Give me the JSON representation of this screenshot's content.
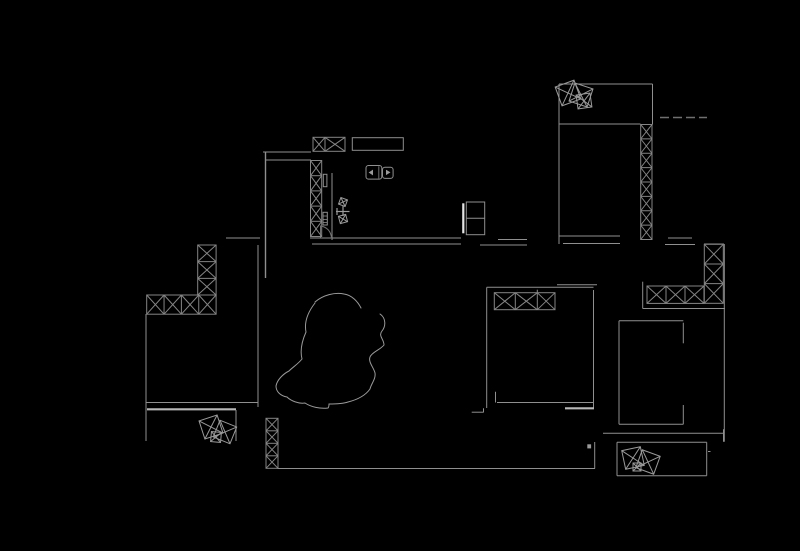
{
  "canvas": {
    "width": 800,
    "height": 551,
    "background": "#000000"
  },
  "colors": {
    "line": "#8f8f8f",
    "hatch": "#858585",
    "dim": "#6f6f6f",
    "bright": "#b8b8b8",
    "symbol": "#9a9a9a",
    "fill_marker": "#9a9a9a",
    "fridge_bar": "#e4e4e4"
  },
  "drawing": {
    "lines": [
      {
        "x1": 263,
        "y1": 152,
        "x2": 311,
        "y2": 152
      },
      {
        "x1": 266,
        "y1": 160,
        "x2": 311,
        "y2": 160
      },
      {
        "x1": 265.5,
        "y1": 152,
        "x2": 265.5,
        "y2": 278,
        "w": 1.4
      },
      {
        "x1": 332,
        "y1": 173,
        "x2": 332,
        "y2": 240
      },
      {
        "x1": 310,
        "y1": 238,
        "x2": 461,
        "y2": 238
      },
      {
        "x1": 312,
        "y1": 244,
        "x2": 461,
        "y2": 244
      },
      {
        "x1": 226,
        "y1": 238,
        "x2": 260,
        "y2": 238
      },
      {
        "x1": 258,
        "y1": 245,
        "x2": 258,
        "y2": 407
      },
      {
        "x1": 320.5,
        "y1": 225.5,
        "x2": 320.5,
        "y2": 237.5,
        "c": "dim"
      },
      {
        "x1": 498,
        "y1": 239.5,
        "x2": 527,
        "y2": 239.5
      },
      {
        "x1": 480,
        "y1": 245,
        "x2": 527,
        "y2": 245
      },
      {
        "x1": 559,
        "y1": 236,
        "x2": 620,
        "y2": 236
      },
      {
        "x1": 563,
        "y1": 243.5,
        "x2": 620,
        "y2": 243.5
      },
      {
        "x1": 559,
        "y1": 234,
        "x2": 559,
        "y2": 244
      },
      {
        "x1": 668,
        "y1": 238,
        "x2": 692,
        "y2": 238
      },
      {
        "x1": 665,
        "y1": 244.5,
        "x2": 695,
        "y2": 244.5
      },
      {
        "x1": 704,
        "y1": 244,
        "x2": 724,
        "y2": 244
      },
      {
        "x1": 559,
        "y1": 84,
        "x2": 652.5,
        "y2": 84
      },
      {
        "x1": 559,
        "y1": 84,
        "x2": 559,
        "y2": 238.5
      },
      {
        "x1": 652.5,
        "y1": 84,
        "x2": 652.5,
        "y2": 124.5
      },
      {
        "x1": 559,
        "y1": 124,
        "x2": 640.5,
        "y2": 124
      },
      {
        "x1": 660,
        "y1": 117.5,
        "x2": 707,
        "y2": 117.5,
        "c": "dim",
        "w": 1.5,
        "dash": "9,4"
      },
      {
        "x1": 563,
        "y1": 243.5,
        "x2": 588,
        "y2": 243.5
      },
      {
        "x1": 724.3,
        "y1": 244,
        "x2": 724.3,
        "y2": 441.7
      },
      {
        "x1": 642.7,
        "y1": 281.7,
        "x2": 642.7,
        "y2": 308.5
      },
      {
        "x1": 642.7,
        "y1": 308.5,
        "x2": 725,
        "y2": 308.5
      },
      {
        "x1": 603,
        "y1": 433.3,
        "x2": 723.3,
        "y2": 433.3
      },
      {
        "x1": 723.5,
        "y1": 429.3,
        "x2": 723.5,
        "y2": 441.7
      },
      {
        "x1": 619,
        "y1": 320.7,
        "x2": 683.3,
        "y2": 320.7
      },
      {
        "x1": 619,
        "y1": 320.7,
        "x2": 619,
        "y2": 424.3
      },
      {
        "x1": 619,
        "y1": 424.3,
        "x2": 683.3,
        "y2": 424.3
      },
      {
        "x1": 683.3,
        "y1": 322.7,
        "x2": 683.3,
        "y2": 343.3
      },
      {
        "x1": 683.3,
        "y1": 405,
        "x2": 683.3,
        "y2": 424.3
      },
      {
        "x1": 617,
        "y1": 442.3,
        "x2": 706.7,
        "y2": 442.3
      },
      {
        "x1": 617,
        "y1": 442.3,
        "x2": 617,
        "y2": 475.7
      },
      {
        "x1": 617,
        "y1": 475.7,
        "x2": 706.7,
        "y2": 475.7
      },
      {
        "x1": 706.7,
        "y1": 442.3,
        "x2": 706.7,
        "y2": 475.7
      },
      {
        "x1": 708,
        "y1": 451.5,
        "x2": 710.5,
        "y2": 451.5
      },
      {
        "x1": 486.7,
        "y1": 287.3,
        "x2": 593.5,
        "y2": 287.3
      },
      {
        "x1": 557,
        "y1": 284.8,
        "x2": 597,
        "y2": 284.8
      },
      {
        "x1": 486.7,
        "y1": 287.3,
        "x2": 486.7,
        "y2": 408
      },
      {
        "x1": 593.5,
        "y1": 290,
        "x2": 593.5,
        "y2": 408.3
      },
      {
        "x1": 497,
        "y1": 402.5,
        "x2": 593.5,
        "y2": 402.5
      },
      {
        "x1": 495.5,
        "y1": 391.7,
        "x2": 495.5,
        "y2": 402.5
      },
      {
        "x1": 537.3,
        "y1": 289.7,
        "x2": 537.3,
        "y2": 292.7
      },
      {
        "x1": 471.7,
        "y1": 412.2,
        "x2": 483.3,
        "y2": 412.2
      },
      {
        "x1": 483.5,
        "y1": 408.3,
        "x2": 483.5,
        "y2": 412.5
      },
      {
        "x1": 277.5,
        "y1": 468.5,
        "x2": 595,
        "y2": 468.5
      },
      {
        "x1": 594.7,
        "y1": 442,
        "x2": 594.7,
        "y2": 468.5
      },
      {
        "x1": 565,
        "y1": 408.3,
        "x2": 594,
        "y2": 408.3,
        "c": "bright",
        "w": 2.2
      },
      {
        "x1": 146,
        "y1": 402.5,
        "x2": 258,
        "y2": 402.5
      },
      {
        "x1": 147,
        "y1": 409.3,
        "x2": 236,
        "y2": 409.3,
        "c": "bright",
        "w": 2.2
      },
      {
        "x1": 236,
        "y1": 410,
        "x2": 236,
        "y2": 441
      },
      {
        "x1": 146,
        "y1": 314,
        "x2": 146,
        "y2": 441
      },
      {
        "x1": 466.3,
        "y1": 218.3,
        "x2": 484.7,
        "y2": 218.3
      },
      {
        "x1": 378.8,
        "y1": 166.3,
        "x2": 378.8,
        "y2": 178.5,
        "c": "dim"
      },
      {
        "x1": 323,
        "y1": 216,
        "x2": 327.3,
        "y2": 216,
        "c": "dim"
      },
      {
        "x1": 323,
        "y1": 219.5,
        "x2": 327.3,
        "y2": 219.5,
        "c": "dim"
      },
      {
        "x1": 323,
        "y1": 222.5,
        "x2": 327.3,
        "y2": 222.5,
        "c": "dim"
      },
      {
        "x1": 337,
        "y1": 208,
        "x2": 337,
        "y2": 215,
        "c": "symbol",
        "w": 1.2
      },
      {
        "x1": 336,
        "y1": 211.5,
        "x2": 349.5,
        "y2": 211.5,
        "c": "symbol",
        "w": 1.2
      },
      {
        "x1": 343,
        "y1": 206,
        "x2": 343,
        "y2": 216,
        "c": "symbol",
        "w": 1.2
      }
    ],
    "rects": [
      {
        "name": "range-hood-cabinet",
        "x": 352.3,
        "y": 137.7,
        "w": 51,
        "h": 12.6
      },
      {
        "name": "fridge-body",
        "x": 466.3,
        "y": 202,
        "w": 18.4,
        "h": 32.7
      },
      {
        "name": "kitchen-fixture-small-1",
        "x": 323.3,
        "y": 174.3,
        "w": 3.6,
        "h": 12.4
      },
      {
        "name": "kitchen-fixture-small-2",
        "x": 323,
        "y": 212.3,
        "w": 4.3,
        "h": 12.7
      },
      {
        "name": "appliance-left",
        "x": 366,
        "y": 165.5,
        "w": 15.8,
        "h": 13.6,
        "rx": 2.5
      },
      {
        "name": "appliance-right",
        "x": 382.5,
        "y": 167.2,
        "w": 10.6,
        "h": 11.2,
        "rx": 2.5
      }
    ],
    "hatches": [
      {
        "name": "window-kitchen-top",
        "x": 313,
        "y": 137.3,
        "w": 32,
        "h": 14,
        "dir": "h",
        "cellw": [
          12,
          20
        ]
      },
      {
        "name": "column-kitchen",
        "x": 310.5,
        "y": 160.5,
        "w": 11.2,
        "h": 76,
        "dir": "v",
        "cells": 5
      },
      {
        "name": "column-top-right",
        "x": 640.7,
        "y": 124.5,
        "w": 11.3,
        "h": 115,
        "dir": "v",
        "cells": 8
      },
      {
        "name": "wall-strip-right",
        "x": 647,
        "y": 286,
        "w": 57,
        "h": 17.4,
        "dir": "h",
        "cells": 3
      },
      {
        "name": "column-right",
        "x": 704.3,
        "y": 244.3,
        "w": 19,
        "h": 59,
        "dir": "v",
        "cells": 3
      },
      {
        "name": "column-left",
        "x": 197.7,
        "y": 245,
        "w": 18.4,
        "h": 50,
        "dir": "v",
        "cells": 3
      },
      {
        "name": "window-left",
        "x": 146.7,
        "y": 295,
        "w": 69.4,
        "h": 19.2,
        "dir": "h",
        "cells": 4
      },
      {
        "name": "column-bottom-left",
        "x": 266,
        "y": 418.3,
        "w": 12,
        "h": 50,
        "dir": "v",
        "cells": 4
      },
      {
        "name": "window-bedroom",
        "x": 494.3,
        "y": 292.7,
        "w": 60.7,
        "h": 17,
        "dir": "h",
        "cellw": [
          21,
          22,
          17.7
        ]
      }
    ],
    "paths": [
      {
        "name": "door-arc-kitchen",
        "d": "M321,226 Q330.5,228 331.5,238",
        "c": "dim"
      },
      {
        "name": "cloud-top",
        "d": "M315,302 C323,295 335,292 344,294 C352,295 358,302 361,308",
        "c": "symbol"
      },
      {
        "name": "cloud-right",
        "d": "M380,314 C386,318 386,326 382,331 C378,336 384,339 384,345 C380,350 372,352 370,357 C368,362 374,368 375,373 C376,379 371,384 370,389 C365,396 356,400 348,402 C342,404 335,404 329,404",
        "c": "symbol"
      },
      {
        "name": "cloud-left",
        "d": "M315,303 C308,312 304,322 306,332 C302,341 300,351 302,359 C298,364 293,367 289,371 C283,374 277,380 276,386 C276,392 281,396 287,397 C291,401 299,404 305,403 C311,407 320,409 328,408 C329,407 329,405 329,404",
        "c": "symbol"
      },
      {
        "name": "appliance-left-knob",
        "d": "M372.5,170.5 L369.5,172.5 L372.5,174.5 Z",
        "c": "symbol",
        "fill": "#9a9a9a"
      },
      {
        "name": "appliance-right-knob",
        "d": "M386.5,170.6 L389.5,172.4 L386.5,174.2 Z",
        "c": "symbol",
        "fill": "#9a9a9a"
      }
    ],
    "clusters": [
      {
        "name": "decor-squares-top-right-room",
        "squares": [
          [
            568,
            93,
            20,
            -20
          ],
          [
            581,
            95,
            19,
            18
          ],
          [
            584,
            101,
            14,
            -8
          ]
        ]
      },
      {
        "name": "decor-squares-entry",
        "squares": [
          [
            211,
            427,
            19,
            -18
          ],
          [
            225,
            432,
            18,
            22
          ],
          [
            216,
            437,
            10,
            5
          ]
        ]
      },
      {
        "name": "decor-squares-bottom-right",
        "squares": [
          [
            633,
            458,
            19,
            -12
          ],
          [
            648,
            462,
            19,
            20
          ],
          [
            637,
            467,
            8,
            0
          ]
        ]
      },
      {
        "name": "sink-fixture-top",
        "squares": [
          [
            343,
            202,
            7,
            20
          ]
        ]
      },
      {
        "name": "sink-fixture-bottom",
        "squares": [
          [
            343,
            219,
            7.5,
            -15
          ]
        ]
      }
    ],
    "markers": [
      {
        "name": "fridge-highlight-bar",
        "x": 462.2,
        "y": 203.3,
        "w": 2.2,
        "h": 30,
        "fill": "#e4e4e4"
      },
      {
        "name": "small-gray-dot",
        "x": 587.3,
        "y": 444.3,
        "w": 3.8,
        "h": 4.1,
        "fill": "#9a9a9a"
      }
    ]
  }
}
